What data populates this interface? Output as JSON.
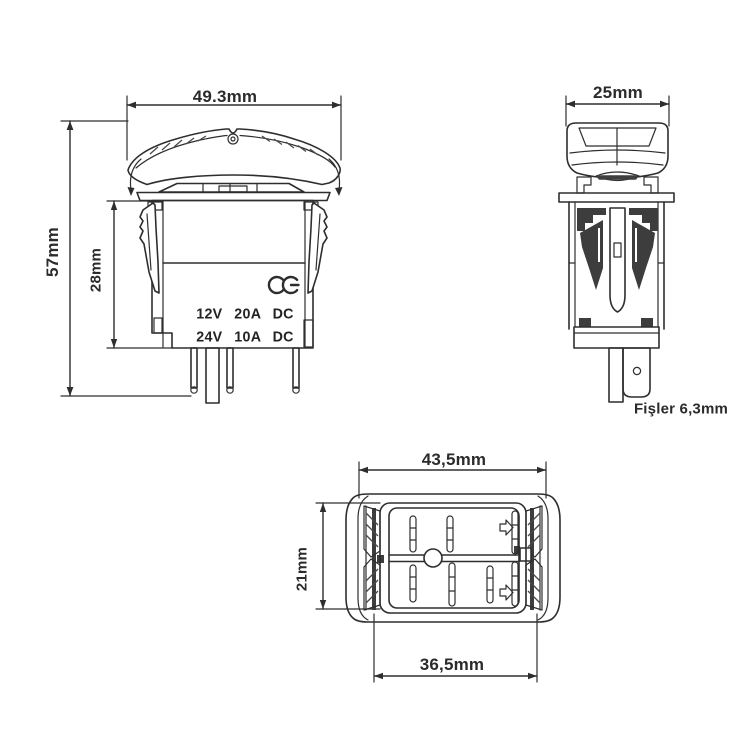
{
  "drawing": {
    "title": "Rocker switch dimensional drawing",
    "front_view": {
      "dim_width": "49.3mm",
      "dim_total_height": "57mm",
      "dim_body_height": "28mm",
      "rating_line1": "12V 20A DC",
      "rating_line2": "24V 10A DC",
      "certification_icon": "ce-mark"
    },
    "side_view": {
      "dim_depth": "25mm",
      "terminal_note": "Fişler 6,3mm"
    },
    "bottom_view": {
      "dim_outer_width": "43,5mm",
      "dim_height": "21mm",
      "dim_inner_width": "36,5mm"
    },
    "colors": {
      "line": "#2e2e2e",
      "text": "#2b2b2b",
      "background": "#ffffff"
    }
  }
}
